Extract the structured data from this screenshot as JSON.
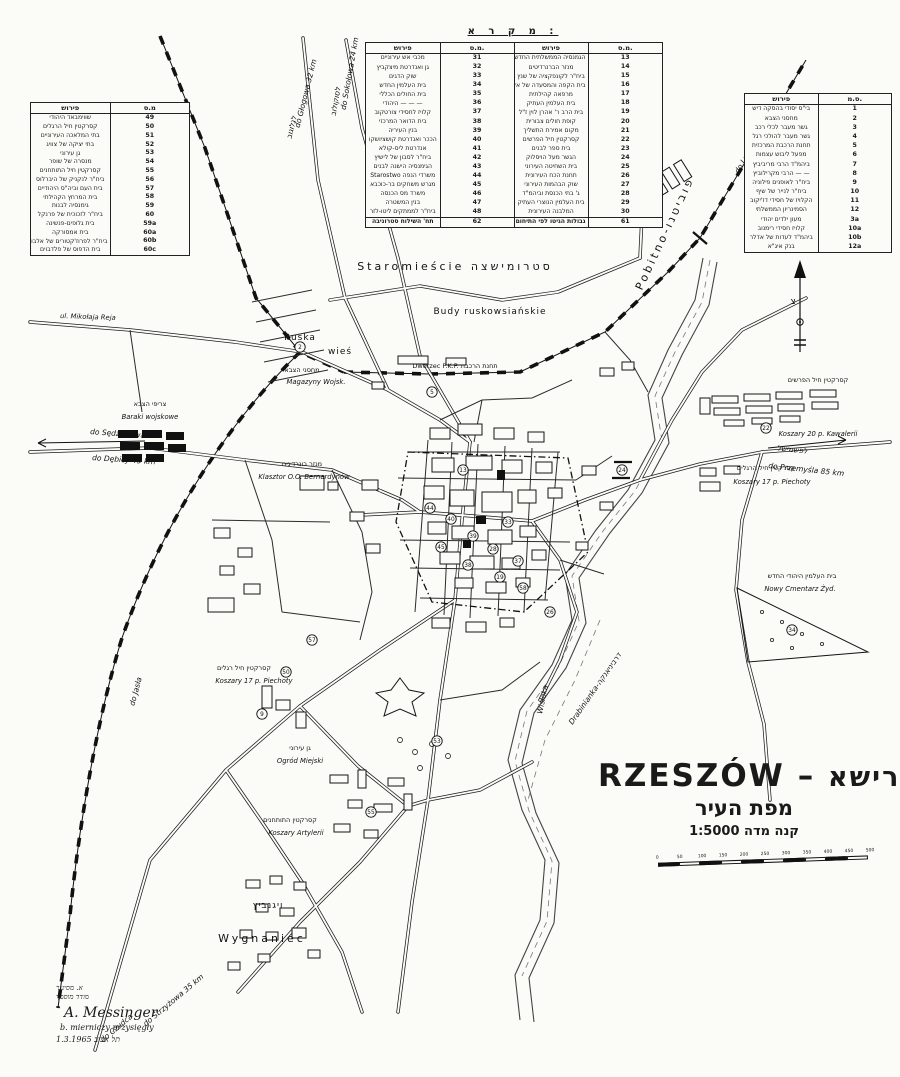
{
  "legend_main": {
    "title": "מ ק ר א :",
    "headers": [
      "פירוש",
      "מ.ס.",
      "פירוש",
      "מ.ס."
    ],
    "rows": [
      [
        "מכבי אש עירוניים",
        "31",
        "הגמנסיה הממשלתית החדשה",
        "13"
      ],
      [
        "גן ואנדרטת מיצקביץ",
        "32",
        "מנזר הברנרדיטים",
        "14"
      ],
      [
        "שוק הדגים",
        "33",
        "ביח\"ר לקונפקציה של שנץ",
        "15"
      ],
      [
        "בית העלמין החדש",
        "34",
        "בית הקפה והמסעדה של אקשטיין",
        "16"
      ],
      [
        "בית החולים הכללי",
        "35",
        "מרפאה קהילתית",
        "17"
      ],
      [
        "— — —  היהודי",
        "36",
        "בית העלמין העתיק",
        "18"
      ],
      [
        "קלויז לחסידי צורטקוב",
        "37",
        "בית הרב ר' אהרן לוין ז\"ל",
        "19"
      ],
      [
        "בית הדואר המרכזי",
        "38",
        "קופת חולים צבורית",
        "20"
      ],
      [
        "בנין העיריה",
        "39",
        "מקום אמירת התשליך",
        "21"
      ],
      [
        "הככר ואנדרטת קושציושקו",
        "40",
        "קסרקטין חיל הפרשים",
        "22"
      ],
      [
        "אנדרטת ליס-קולא",
        "41",
        "בית ספר לבנים",
        "23"
      ],
      [
        "ביח\"ר לסבון של לישיץ",
        "42",
        "הגשר מעל הויסלוק",
        "24"
      ],
      [
        "הגימנסיה הישנה לבנים",
        "43",
        "בית השחיטה העירוני",
        "25"
      ],
      [
        "משרדי הנפה Starostwo",
        "44",
        "תחנת הכח העירונית",
        "26"
      ],
      [
        "מגרש משחקים בר-כוכבא",
        "45",
        "שוק הבהמות העירוני",
        "27"
      ],
      [
        "משרד מס הכנסה",
        "46",
        "ג' בתי הכנסת וביהמ\"ד",
        "28"
      ],
      [
        "בנין המשטרה",
        "47",
        "בית העלמין הנוצרי העתיק",
        "29"
      ],
      [
        "ביח\"ר לממתקים ליטו-לזר",
        "48",
        "המלבנה העירונית",
        "30"
      ]
    ],
    "footer": [
      "תח' השילוח סטרוניבה",
      "62",
      "גבולות הגיטו לפי התיחום",
      "61"
    ]
  },
  "legend_left": {
    "headers": [
      "פירוש",
      "מ.ס"
    ],
    "rows": [
      [
        "שווימבאד היהודי",
        "49"
      ],
      [
        "קסרקטין חיל הרגלים",
        "50"
      ],
      [
        "בתי המלאכה העירוניים",
        "51"
      ],
      [
        "בתי יציקה של צוויג",
        "52"
      ],
      [
        "גן עירוני",
        "53"
      ],
      [
        "מנסרה של שופר",
        "54"
      ],
      [
        "קסרקטין חיל התותחנים",
        "55"
      ],
      [
        "ביח\"ר לנקניק של היברלוס",
        "56"
      ],
      [
        "בית העם וביה\"ס היהודיים",
        "57"
      ],
      [
        "בית המרחץ הקהילתי",
        "58"
      ],
      [
        "גימנסיה לבנות",
        "59"
      ],
      [
        "ביח\"ר לזכוכית של פרנקל",
        "60"
      ],
      [
        "בית גלופים-פנשינה",
        "59a"
      ],
      [
        "בית אמסורקה",
        "60a"
      ],
      [
        "ביח\"ר לפרוז'קטורים של אלבוים",
        "60b"
      ],
      [
        "בית הדפוס של פלדבוים",
        "60c"
      ]
    ]
  },
  "legend_right": {
    "headers": [
      "פירוש",
      "ס.מ."
    ],
    "rows": [
      [
        "בי\"ס יסודי בהסקה דיש",
        "1"
      ],
      [
        "מחסני הצבא",
        "2"
      ],
      [
        "גשר מעבר לכלי רכב",
        "3"
      ],
      [
        "גשר מעבר להולכי רגל",
        "4"
      ],
      [
        "תחנת הרכבת המרכזית",
        "5"
      ],
      [
        "מפעל ליבוש עצמות",
        "6"
      ],
      [
        "ביהמ\"ד הרבי מריביביץ",
        "7"
      ],
      [
        "— —  הרבי מקרילוביץ",
        "8"
      ],
      [
        "ביח\"ר לאופנים פילוניה",
        "9"
      ],
      [
        "ביח\"ר לנייר של שיף",
        "10"
      ],
      [
        "הקלויז של חסידי דז'יקוב",
        "11"
      ],
      [
        "הסמינריון הממשלתי",
        "12"
      ],
      [
        "מעון ילדים יהודי",
        "3a"
      ],
      [
        "קלויז חסידי רימנוב",
        "10a"
      ],
      [
        "ביהמ\"ד לעדות של אדלר",
        "10b"
      ],
      [
        "בנק איג\"א",
        "12a"
      ]
    ]
  },
  "map_labels": {
    "staromiescie": "Staromieście  סטרומישצה",
    "budy": "Budy ruskowsiańskie",
    "ruska": "Ruska",
    "wies": "wieś",
    "pobitno": "Pobitno-פוביטנו",
    "wygnaniec_he": "ויגנביץ",
    "wygnaniec": "Wygnaniec",
    "drabinianka": "Drabinianka-דרביניאנקה",
    "wisloka": "Wisłoka",
    "do_lwowa": "do Lwowa",
    "do_lwowa_he": "ללבוב",
    "do_sokolowa": "do Sokołowa 24 km",
    "do_sokolowa_he": "לסוקולוב",
    "do_glogowa": "do Głogowa 32 km",
    "do_glogowa_he": "לגלוגוב",
    "do_sedziszowa": "do Sędziszowa",
    "do_debicy": "do Dębicy 45 km",
    "do_jasla": "do Jasła",
    "do_strzyzowa": "do Strzyżowa 35 km",
    "do_czudca": "do Czudca",
    "do_przemysla": "do Przemyśla 85 km",
    "do_przemysla_he": "לפשמישל",
    "dworzec": "Dworzec P.K.P.  תחנת הרכבת",
    "magazyny_he": "מחסני הצבא",
    "magazyny": "Magazyny Wojsk.",
    "baraki_he": "צריפי הצבא",
    "baraki": "Baraki wojskowe",
    "klasztor_he": "מנזר בונרדינים",
    "klasztor": "Klasztor O.O. Bernardynów",
    "kawaleria_he": "קסרקטין חיל הפרשים",
    "kawaleria": "Koszary 20 p. Kawalerii",
    "piechota_r_he": "קסרקטין חיל הרגלים",
    "piechota_r": "Koszary 17 p. Piechoty",
    "piechota_l_he": "קסרקטין חיל רגלים",
    "piechota_l": "Koszary 17 p. Piechoty",
    "artyleria_he": "קסרקטין התותחנים",
    "artyleria": "Koszary Artylerii",
    "ogrod_he": "גן עירוני",
    "ogrod": "Ogród Miejski",
    "cmentarz_he": "בית העלמין היהודי החדש",
    "cmentarz": "Nowy Cmentarz Żyd.",
    "ul_reja": "ul. Mikołaja Reja",
    "compass": "צ"
  },
  "map_markers": [
    {
      "n": "2",
      "x": 300,
      "y": 347
    },
    {
      "n": "5",
      "x": 432,
      "y": 392
    },
    {
      "n": "22",
      "x": 766,
      "y": 428
    },
    {
      "n": "24",
      "x": 622,
      "y": 470
    },
    {
      "n": "13",
      "x": 463,
      "y": 470
    },
    {
      "n": "39",
      "x": 473,
      "y": 536
    },
    {
      "n": "40",
      "x": 451,
      "y": 519
    },
    {
      "n": "44",
      "x": 430,
      "y": 508
    },
    {
      "n": "28",
      "x": 493,
      "y": 549
    },
    {
      "n": "33",
      "x": 508,
      "y": 522
    },
    {
      "n": "38",
      "x": 468,
      "y": 565
    },
    {
      "n": "45",
      "x": 441,
      "y": 547
    },
    {
      "n": "37",
      "x": 518,
      "y": 561
    },
    {
      "n": "19",
      "x": 500,
      "y": 577
    },
    {
      "n": "26",
      "x": 550,
      "y": 612
    },
    {
      "n": "58",
      "x": 523,
      "y": 588
    },
    {
      "n": "50",
      "x": 286,
      "y": 672
    },
    {
      "n": "53",
      "x": 437,
      "y": 741
    },
    {
      "n": "55",
      "x": 371,
      "y": 812
    },
    {
      "n": "34",
      "x": 792,
      "y": 630
    },
    {
      "n": "57",
      "x": 312,
      "y": 640
    },
    {
      "n": "9",
      "x": 262,
      "y": 714
    }
  ],
  "title_block": {
    "latin": "RZESZÓW",
    "sep": "–",
    "hebrew": "רישא",
    "subtitle": "מפת העיר",
    "scale_label": "קנה מדה  1:5000"
  },
  "scale_bar": {
    "ticks": [
      "0",
      "50",
      "100",
      "150",
      "200",
      "250",
      "300",
      "350",
      "400",
      "450",
      "500"
    ]
  },
  "signature": {
    "he1": "א. מסינגר",
    "he2": "מודד מוסמך",
    "name": "A. Messinger",
    "role": "b. mierniczy przysięgły",
    "place_date": "תל אביב   1.3.1965"
  }
}
